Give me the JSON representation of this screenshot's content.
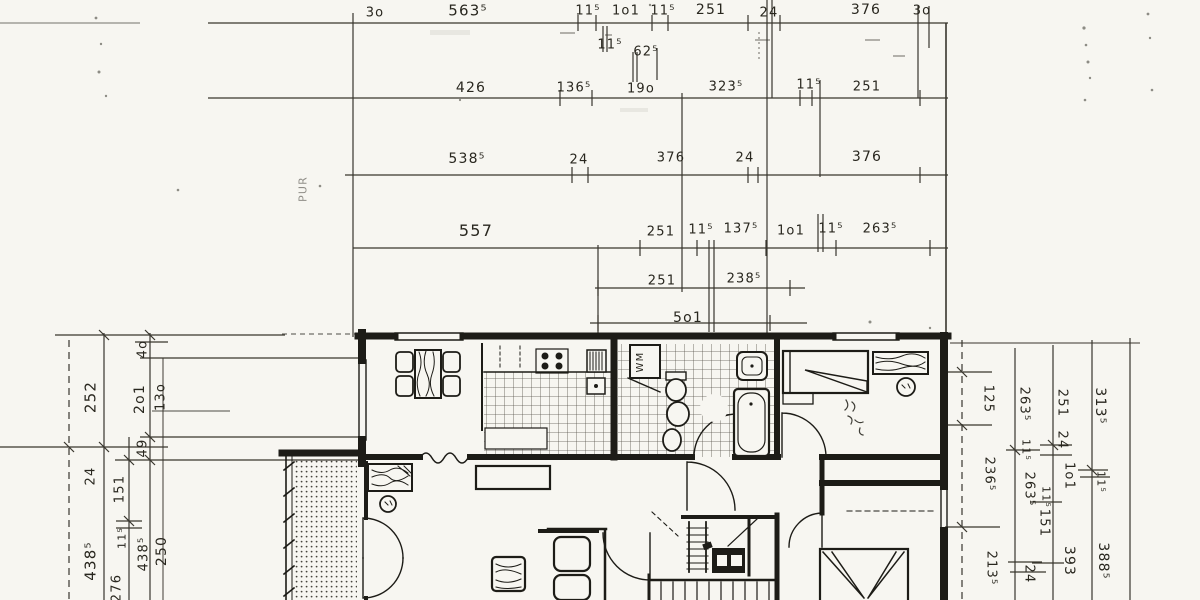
{
  "drawing": {
    "kind": "scanned architectural floor plan with dimension chains",
    "paper_color": "#f7f6f1",
    "ink_color": "#26241f",
    "units_note": "dimension figures as drawn (superscript 5 = half centimetre)"
  },
  "dimension_labels": {
    "top": [
      {
        "t": "3o",
        "x": 375,
        "y": 13
      },
      {
        "t": "563⁵",
        "x": 468,
        "y": 11,
        "s": 15
      },
      {
        "t": "11⁵",
        "x": 588,
        "y": 11
      },
      {
        "t": "1o1",
        "x": 626,
        "y": 11
      },
      {
        "t": "11⁵",
        "x": 663,
        "y": 11
      },
      {
        "t": "251",
        "x": 711,
        "y": 10,
        "s": 14
      },
      {
        "t": "24",
        "x": 769,
        "y": 13
      },
      {
        "t": "376",
        "x": 866,
        "y": 10,
        "s": 14
      },
      {
        "t": "3o",
        "x": 922,
        "y": 11
      },
      {
        "t": "11⁵",
        "x": 610,
        "y": 45
      },
      {
        "t": "62⁵",
        "x": 646,
        "y": 52
      },
      {
        "t": "426",
        "x": 471,
        "y": 88,
        "s": 14
      },
      {
        "t": "136⁵",
        "x": 574,
        "y": 88
      },
      {
        "t": "19o",
        "x": 641,
        "y": 89
      },
      {
        "t": "323⁵",
        "x": 726,
        "y": 87
      },
      {
        "t": "11⁵",
        "x": 809,
        "y": 85
      },
      {
        "t": "251",
        "x": 867,
        "y": 87
      },
      {
        "t": "538⁵",
        "x": 467,
        "y": 159,
        "s": 14
      },
      {
        "t": "24",
        "x": 579,
        "y": 160
      },
      {
        "t": "376",
        "x": 671,
        "y": 158
      },
      {
        "t": "24",
        "x": 745,
        "y": 158
      },
      {
        "t": "376",
        "x": 867,
        "y": 157,
        "s": 14
      },
      {
        "t": "557",
        "x": 476,
        "y": 231,
        "s": 16
      },
      {
        "t": "251",
        "x": 661,
        "y": 232
      },
      {
        "t": "11⁵",
        "x": 701,
        "y": 230
      },
      {
        "t": "137⁵",
        "x": 741,
        "y": 229
      },
      {
        "t": "1o1",
        "x": 791,
        "y": 231
      },
      {
        "t": "11⁵",
        "x": 831,
        "y": 229
      },
      {
        "t": "263⁵",
        "x": 880,
        "y": 229
      },
      {
        "t": "251",
        "x": 662,
        "y": 281
      },
      {
        "t": "238⁵",
        "x": 744,
        "y": 279
      },
      {
        "t": "5o1",
        "x": 688,
        "y": 318,
        "s": 14
      }
    ],
    "left": [
      {
        "t": "4o",
        "x": 143,
        "y": 349,
        "r": -90
      },
      {
        "t": "252",
        "x": 91,
        "y": 397,
        "r": -90,
        "s": 15
      },
      {
        "t": "2o1",
        "x": 140,
        "y": 399,
        "r": -90,
        "s": 14
      },
      {
        "t": "13o",
        "x": 161,
        "y": 397,
        "r": -90
      },
      {
        "t": "49",
        "x": 143,
        "y": 448,
        "r": -90
      },
      {
        "t": "24",
        "x": 91,
        "y": 476,
        "r": -90
      },
      {
        "t": "151",
        "x": 120,
        "y": 489,
        "r": -90
      },
      {
        "t": "11⁵",
        "x": 122,
        "y": 538,
        "r": -90,
        "s": 11
      },
      {
        "t": "438⁵",
        "x": 144,
        "y": 554,
        "r": -90
      },
      {
        "t": "250",
        "x": 162,
        "y": 551,
        "r": -90,
        "s": 14
      },
      {
        "t": "438⁵",
        "x": 91,
        "y": 561,
        "r": -90,
        "s": 15
      },
      {
        "t": "276",
        "x": 117,
        "y": 588,
        "r": -90
      }
    ],
    "right": [
      {
        "t": "125",
        "x": 988,
        "y": 399,
        "r": 90
      },
      {
        "t": "263⁵",
        "x": 1024,
        "y": 404,
        "r": 90
      },
      {
        "t": "251",
        "x": 1062,
        "y": 403,
        "r": 90
      },
      {
        "t": "313⁵",
        "x": 1100,
        "y": 406,
        "r": 90,
        "s": 14
      },
      {
        "t": "24",
        "x": 1062,
        "y": 440,
        "r": 90
      },
      {
        "t": "11⁵",
        "x": 1026,
        "y": 450,
        "r": 90,
        "s": 11
      },
      {
        "t": "236⁵",
        "x": 989,
        "y": 474,
        "r": 90
      },
      {
        "t": "1o1",
        "x": 1069,
        "y": 476,
        "r": 90
      },
      {
        "t": "11⁵",
        "x": 1101,
        "y": 482,
        "r": 90,
        "s": 11
      },
      {
        "t": "263⁵",
        "x": 1029,
        "y": 489,
        "r": 90
      },
      {
        "t": "11⁵",
        "x": 1046,
        "y": 497,
        "r": 90,
        "s": 11
      },
      {
        "t": "151",
        "x": 1044,
        "y": 523,
        "r": 90
      },
      {
        "t": "393",
        "x": 1069,
        "y": 561,
        "r": 90,
        "s": 14
      },
      {
        "t": "388⁵",
        "x": 1103,
        "y": 561,
        "r": 90,
        "s": 14
      },
      {
        "t": "213⁵",
        "x": 991,
        "y": 568,
        "r": 90
      },
      {
        "t": "24",
        "x": 1029,
        "y": 574,
        "r": 90
      }
    ]
  },
  "annotations": [
    {
      "t": "WM",
      "x": 641,
      "y": 362,
      "r": -90,
      "s": 10
    },
    {
      "t": "PUR",
      "x": 303,
      "y": 189,
      "r": -90,
      "s": 11,
      "faint": true
    }
  ]
}
